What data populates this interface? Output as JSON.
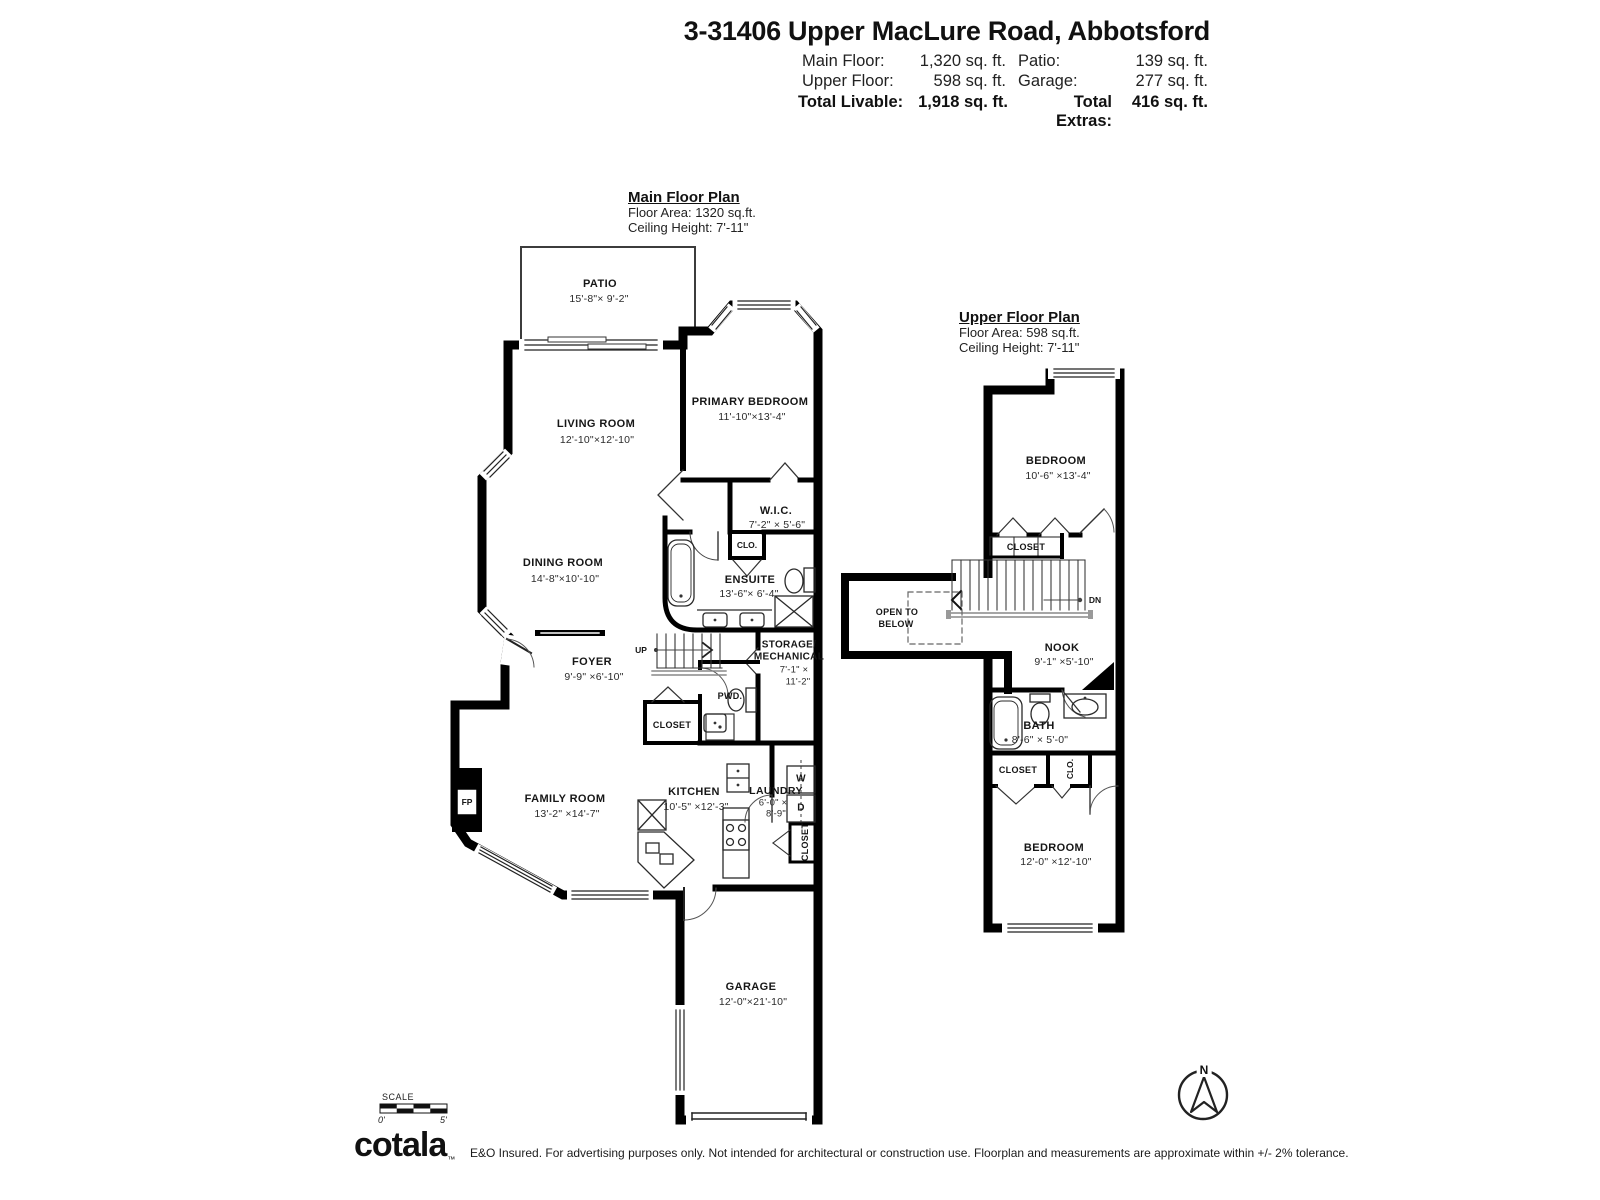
{
  "header": {
    "title": "3-31406 Upper MacLure Road, Abbotsford",
    "stats": {
      "main_floor_label": "Main Floor:",
      "main_floor_value": "1,320 sq. ft.",
      "patio_label": "Patio:",
      "patio_value": "139 sq. ft.",
      "upper_floor_label": "Upper Floor:",
      "upper_floor_value": "598 sq. ft.",
      "garage_label": "Garage:",
      "garage_value": "277 sq. ft.",
      "total_livable_label": "Total Livable:",
      "total_livable_value": "1,918 sq. ft.",
      "total_extras_label": "Total Extras:",
      "total_extras_value": "416 sq. ft."
    }
  },
  "main_floor": {
    "title": "Main Floor Plan",
    "floor_area": "Floor Area: 1320 sq.ft.",
    "ceiling": "Ceiling Height: 7'-11\"",
    "rooms": {
      "patio": {
        "name": "PATIO",
        "dims": "15'-8\"× 9'-2\""
      },
      "living": {
        "name": "LIVING ROOM",
        "dims": "12'-10\"×12'-10\""
      },
      "primary": {
        "name": "PRIMARY BEDROOM",
        "dims": "11'-10\"×13'-4\""
      },
      "wic": {
        "name": "W.I.C.",
        "dims": "7'-2\" × 5'-6\""
      },
      "dining": {
        "name": "DINING ROOM",
        "dims": "14'-8\"×10'-10\""
      },
      "ensuite": {
        "name": "ENSUITE",
        "dims": "13'-6\"× 6'-4\""
      },
      "clo": "CLO.",
      "foyer": {
        "name": "FOYER",
        "dims": "9'-9\" ×6'-10\""
      },
      "storage": {
        "line1": "STORAGE/",
        "line2": "MECHANICAL",
        "dim1": "7'-1\" ×",
        "dim2": "11'-2\""
      },
      "up": "UP",
      "pwd": "PWD.",
      "closet": "CLOSET",
      "family": {
        "name": "FAMILY ROOM",
        "dims": "13'-2\" ×14'-7\""
      },
      "fp": "FP",
      "kitchen": {
        "name": "KITCHEN",
        "dims": "10'-5\" ×12'-3\""
      },
      "laundry": {
        "name": "LAUNDRY",
        "dim1": "6'-0\" ×",
        "dim2": "8'-9\""
      },
      "washer": "W",
      "dryer": "D",
      "closet2": "CLOSET",
      "garage": {
        "name": "GARAGE",
        "dims": "12'-0\"×21'-10\""
      }
    }
  },
  "upper_floor": {
    "title": "Upper Floor Plan",
    "floor_area": "Floor Area: 598 sq.ft.",
    "ceiling": "Ceiling Height: 7'-11\"",
    "rooms": {
      "bedroom1": {
        "name": "BEDROOM",
        "dims": "10'-6\" ×13'-4\""
      },
      "closet1": "CLOSET",
      "dn": "DN",
      "open1": "OPEN TO",
      "open2": "BELOW",
      "nook": {
        "name": "NOOK",
        "dims": "9'-1\" ×5'-10\""
      },
      "bath": {
        "name": "BATH",
        "dims": "8'-6\" × 5'-0\""
      },
      "closet2": "CLOSET",
      "clo": "CLO.",
      "bedroom2": {
        "name": "BEDROOM",
        "dims": "12'-0\" ×12'-10\""
      }
    }
  },
  "footer": {
    "scale_label": "SCALE",
    "scale_start": "0'",
    "scale_end": "5'",
    "north": "N",
    "logo": "cotala",
    "logo_tm": "™",
    "disclaimer": "E&O Insured. For advertising purposes only. Not intended for architectural or construction use. Floorplan and measurements are approximate within +/- 2% tolerance."
  }
}
